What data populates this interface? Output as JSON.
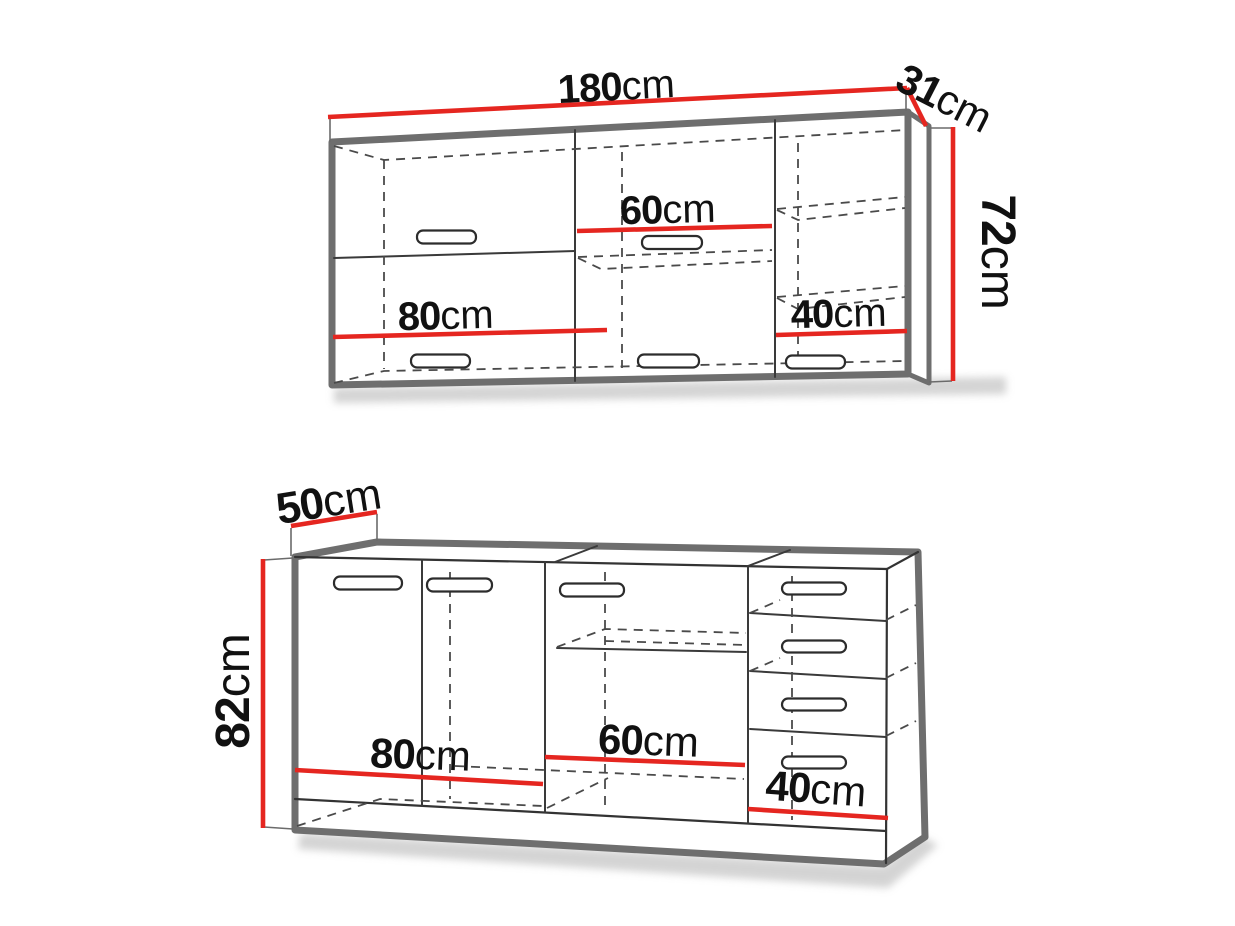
{
  "figure": {
    "type": "kitchen-cabinet-dimension-diagram",
    "units": "cm"
  },
  "wall_cabinet": {
    "width": {
      "num": "180",
      "unit": "cm"
    },
    "depth": {
      "num": "31",
      "unit": "cm"
    },
    "height": {
      "num": "72",
      "unit": "cm"
    },
    "sections": {
      "left": {
        "num": "80",
        "unit": "cm"
      },
      "middle": {
        "num": "60",
        "unit": "cm"
      },
      "right": {
        "num": "40",
        "unit": "cm"
      }
    }
  },
  "base_cabinet": {
    "depth": {
      "num": "50",
      "unit": "cm"
    },
    "height": {
      "num": "82",
      "unit": "cm"
    },
    "sections": {
      "left": {
        "num": "80",
        "unit": "cm"
      },
      "middle": {
        "num": "60",
        "unit": "cm"
      },
      "right": {
        "num": "40",
        "unit": "cm"
      }
    }
  },
  "colors": {
    "dimension_line": "#e52620",
    "outline": "#6e6e6e",
    "detail_line": "#333333",
    "dashed_line": "#4a4a4a",
    "text": "#111111",
    "shadow": "#a9a9a9",
    "background": "#ffffff"
  }
}
